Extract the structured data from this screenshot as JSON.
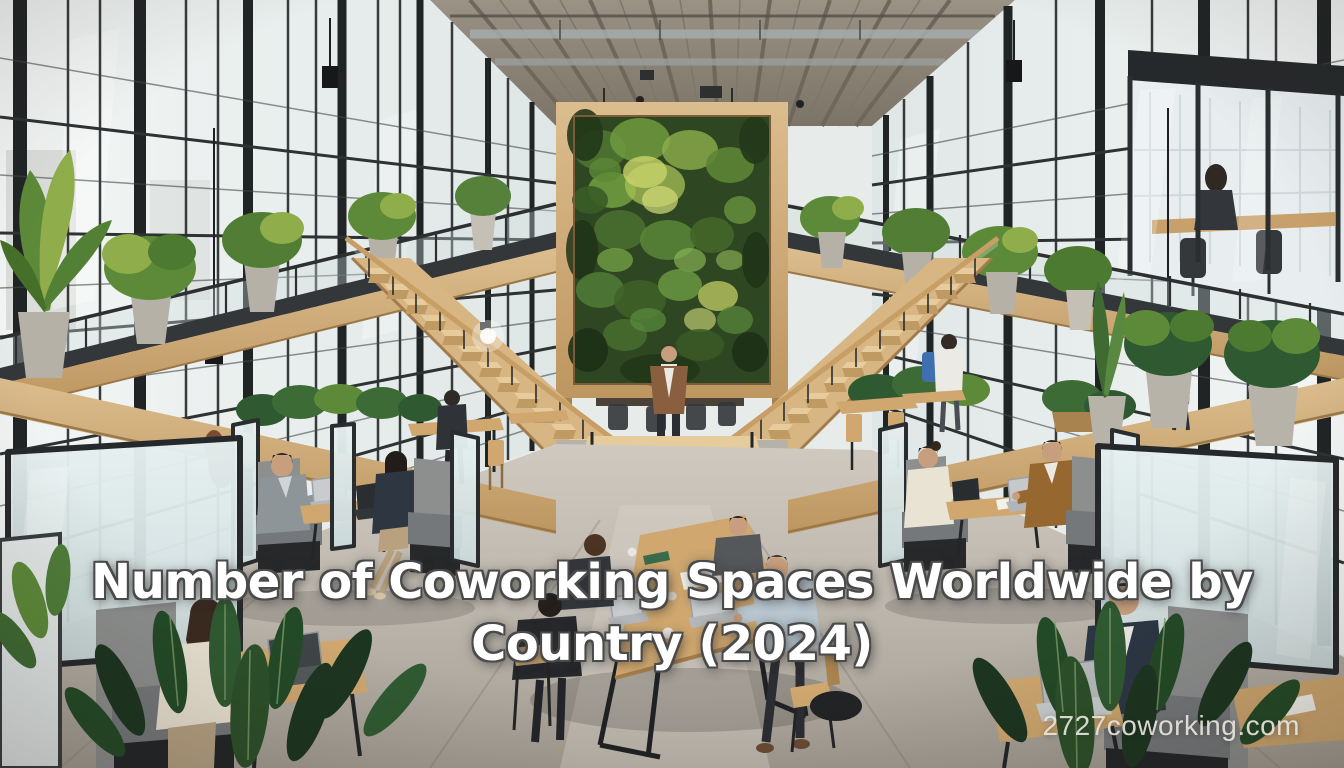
{
  "overlay": {
    "title": "Number of Coworking Spaces Worldwide by Country (2024)",
    "title_lines": [
      "Number of Coworking Spaces Worldwide by",
      "Country (2024)"
    ],
    "watermark": "2727coworking.com"
  },
  "scene": {
    "setting": "industrial coworking atrium with factory windows, mezzanine, living green wall, twin wooden staircases, seating booths and a shared wooden table",
    "elements": [
      "concrete-ceiling",
      "left-window-wall",
      "right-window-wall",
      "living-green-wall",
      "left-staircase",
      "right-staircase",
      "central-landing",
      "standing-person",
      "mezzanine-left",
      "mezzanine-right",
      "glass-meeting-room",
      "seating-booths",
      "central-table",
      "window-side-tables",
      "planters-and-foliage",
      "concrete-floor"
    ]
  },
  "palette": {
    "title_color": "#ffffff",
    "title_outline": "#4a4a4a",
    "watermark_color": "#e6e4dc",
    "wood": "#cfa76f",
    "wood_light": "#e6cb9d",
    "wood_dark": "#a9834f",
    "frame_black": "#26292b",
    "glass_light": "#eef3f2",
    "glass_shade": "#d9e2e1",
    "frosted": "#dde8e8",
    "concrete_ceiling": "#8d8679",
    "floor_light": "#c9c3ba",
    "floor_dark": "#a09a90",
    "green_dark": "#2e4621",
    "green_mid": "#5d8a39",
    "green_light": "#8fae4b",
    "green_yellow": "#cdd86e",
    "foliage_dark": "#1c3520",
    "foliage_mid": "#2f5a31",
    "upholstery": "#8d8f8e",
    "upholstery_dark": "#75787a",
    "skin": "#c79e7e"
  }
}
